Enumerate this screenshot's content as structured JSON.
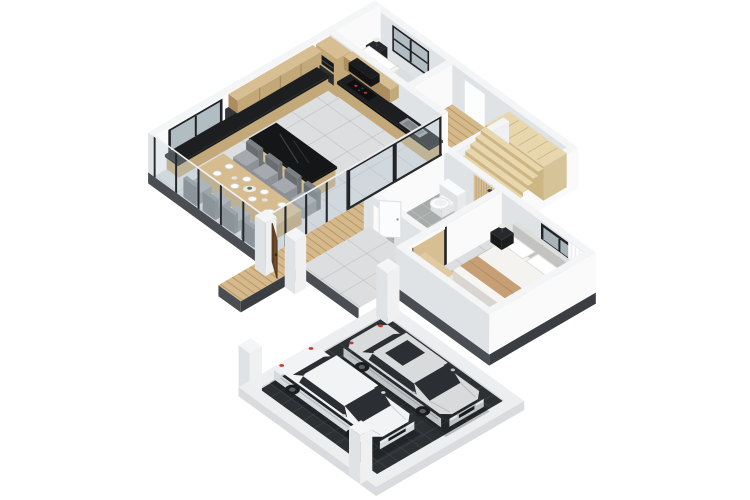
{
  "scene": {
    "title": "3D isometric floor plan render of a single-storey house with carport",
    "view": "isometric dollhouse cutaway, white background",
    "background": "#ffffff",
    "rooms": [
      {
        "name": "kitchen-dining",
        "features": [
          "wood-upper-cabinets",
          "wood-base-cabinets",
          "black-countertops",
          "dark-backsplash",
          "cooktop-with-red-burners",
          "sink",
          "tall-cabinet-with-oven-and-microwave",
          "black-top-kitchen-island",
          "3-gray-bar-stools",
          "wood-dining-table",
          "8-gray-chairs",
          "white-place-settings",
          "centerpiece",
          "black-framed-window",
          "glass-curtain-walls-with-dark-posts"
        ]
      },
      {
        "name": "small-bedroom",
        "features": [
          "single-bed-white-bedding",
          "dark-nightstand",
          "table-lamp",
          "black-framed-window"
        ]
      },
      {
        "name": "hallway",
        "features": [
          "wood-plank-floor",
          "white-interior-door",
          "glass-sliding-doors-black-frames"
        ]
      },
      {
        "name": "staircase",
        "features": [
          "8-wood-treads",
          "upper-wood-landing",
          "white-half-wall",
          "dark-landing-window"
        ]
      },
      {
        "name": "bathroom",
        "features": [
          "toilet",
          "washbasin",
          "wood-slat-shower-wall",
          "shower-head",
          "gray-mosaic-tile-floor",
          "white-door-ajar"
        ]
      },
      {
        "name": "master-bedroom",
        "features": [
          "double-bed-white-bedding",
          "tan-runner",
          "two-pillows",
          "two-dark-nightstands",
          "two-table-lamps",
          "gray-area-rug",
          "black-framed-window",
          "white-curtain",
          "wood-wardrobe",
          "doorway-with-black-frame"
        ]
      },
      {
        "name": "entry-deck",
        "features": [
          "wood-plank-walkway",
          "open-wood-pivot-door",
          "white-jamb-pillars"
        ]
      },
      {
        "name": "carport",
        "features": [
          "dark-grid-tile-slab",
          "white-perimeter-curb",
          "three-white-pillars",
          "two-parked-cars"
        ]
      }
    ],
    "cars": [
      {
        "name": "white-sedan",
        "color": "#f2f3f4",
        "position": "left-bay",
        "detail": "red-taillights"
      },
      {
        "name": "silver-sedan",
        "color": "#d8dadc",
        "position": "right-bay",
        "detail": "sunroof"
      }
    ],
    "colors": {
      "background": "#ffffff",
      "wallTop": "#f4f5f6",
      "wallLight": "#fafafb",
      "wallMid": "#eef0f1",
      "wallShade": "#e0e3e6",
      "plinth": "#4a4d52",
      "plinthDark": "#3a3d41",
      "tile": "#dcdee0",
      "tileLine": "rgba(110,115,120,0.16)",
      "bathTile": "#a7acaa",
      "bathLine": "rgba(255,255,255,0.25)",
      "showerFloor": "#979d9a",
      "wood": "#d8bf93",
      "woodSide": "#c3a87a",
      "woodTop": "#e0caa0",
      "woodDark": "#ab8d60",
      "deck": "#d5b98a",
      "deckGap": "rgba(115,85,45,0.35)",
      "stair": "#e8d6ac",
      "stairRise": "#cdb584",
      "stairSide": "#d6c498",
      "counter": "#1c1e20",
      "counterDark": "#121416",
      "island": "#141618",
      "chair": "#a6aaae",
      "chairSide": "#8e9296",
      "chairBack": "#7b8084",
      "tableTop": "#d6bc8f",
      "tableSide": "#bfa273",
      "glass": "rgba(188,206,215,0.32)",
      "frame": "#202225",
      "glassDark": "#272a2e",
      "paneBlue": "#c2ced5",
      "bedWhite": "#f4f3f0",
      "bedShade": "#e1dfdb",
      "tan": "#c79f74",
      "tanDark": "#b58f67",
      "rug": "#b7babc",
      "rugDark": "#a5a8aa",
      "pad": "#2c3033",
      "padLine": "#3b3f44",
      "curb": "#edeef0",
      "curbSide": "#d9dbde",
      "car1": "#f2f3f4",
      "car1Side": "#d7dadc",
      "car2": "#d8dadc",
      "car2Side": "#bfc3c6",
      "carGlass": "#2b2e32",
      "tyre": "#1b1d1f",
      "red": "#c13a2c",
      "doorWood": "#6f4c2d",
      "doorWoodDark": "#5a3c22",
      "toiletWhite": "#fafbfc",
      "lampDark": "#26282b",
      "lampShade": "#ece9e4",
      "shadow": "rgba(0,0,0,0.22)",
      "green": "#5e7a52",
      "white": "#ffffff",
      "backsplash": "#1f2224",
      "appliance": "#17191b",
      "sink": "#9aa0a3",
      "sinkDeep": "#7f868a"
    }
  }
}
